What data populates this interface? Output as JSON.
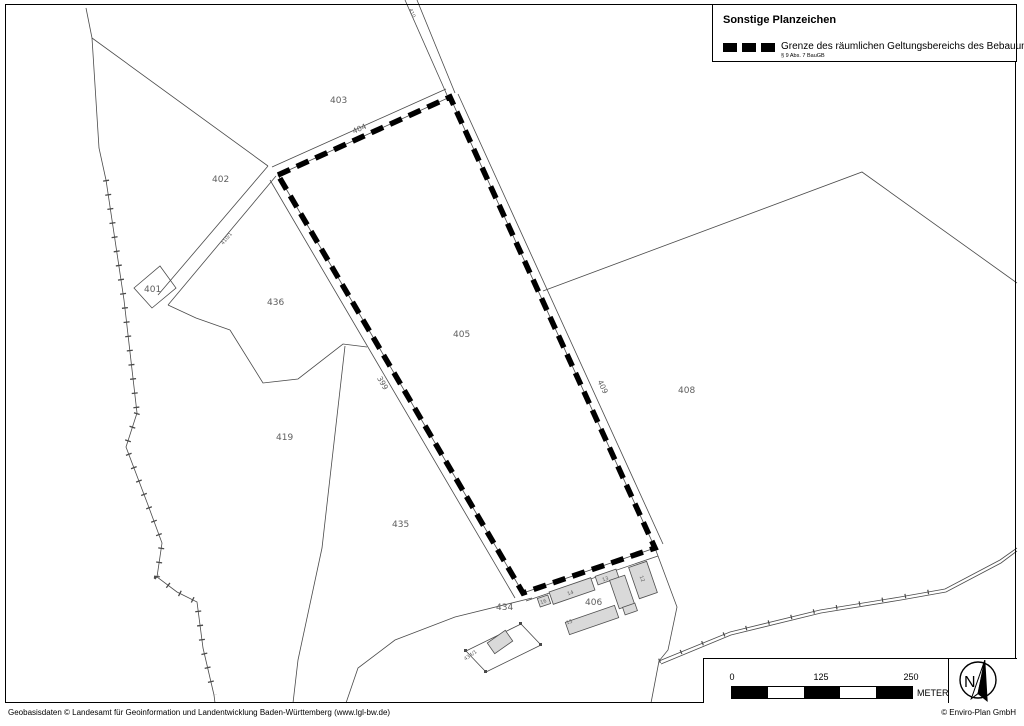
{
  "legend": {
    "title": "Sonstige Planzeichen",
    "item": {
      "label": "Grenze des räumlichen Geltungsbereichs des Bebauungsplans",
      "sublabel": "§ 9 Abs. 7 BauGB",
      "symbol": "black-dashed-line",
      "symbol_color": "#000000"
    }
  },
  "scale_bar": {
    "tick_0": "0",
    "tick_mid": "125",
    "tick_max": "250",
    "unit": "METER"
  },
  "north_arrow": {
    "letter": "N"
  },
  "footer": {
    "left": "Geobasisdaten © Landesamt für Geoinformation und Landentwicklung Baden-Württemberg (www.lgl-bw.de)",
    "right": "© Enviro-Plan GmbH"
  },
  "map": {
    "plan_boundary_color": "#000000",
    "parcel_line_color": "#4a4a4a",
    "building_fill": "#d9d9d9",
    "label_color": "#5e5e5e",
    "labels": {
      "p399": "399",
      "p401": "401",
      "p402": "402",
      "p403": "403",
      "p404": "404",
      "p405": "405",
      "p406": "406",
      "p408": "408",
      "p409": "409",
      "p410": "410",
      "p410_1": "410/1",
      "p419": "419",
      "p434": "434",
      "p434_1": "434/1",
      "p435": "435",
      "p436": "436",
      "b12": "12",
      "b13": "13",
      "b14": "14",
      "b15": "15",
      "b16": "16"
    }
  }
}
